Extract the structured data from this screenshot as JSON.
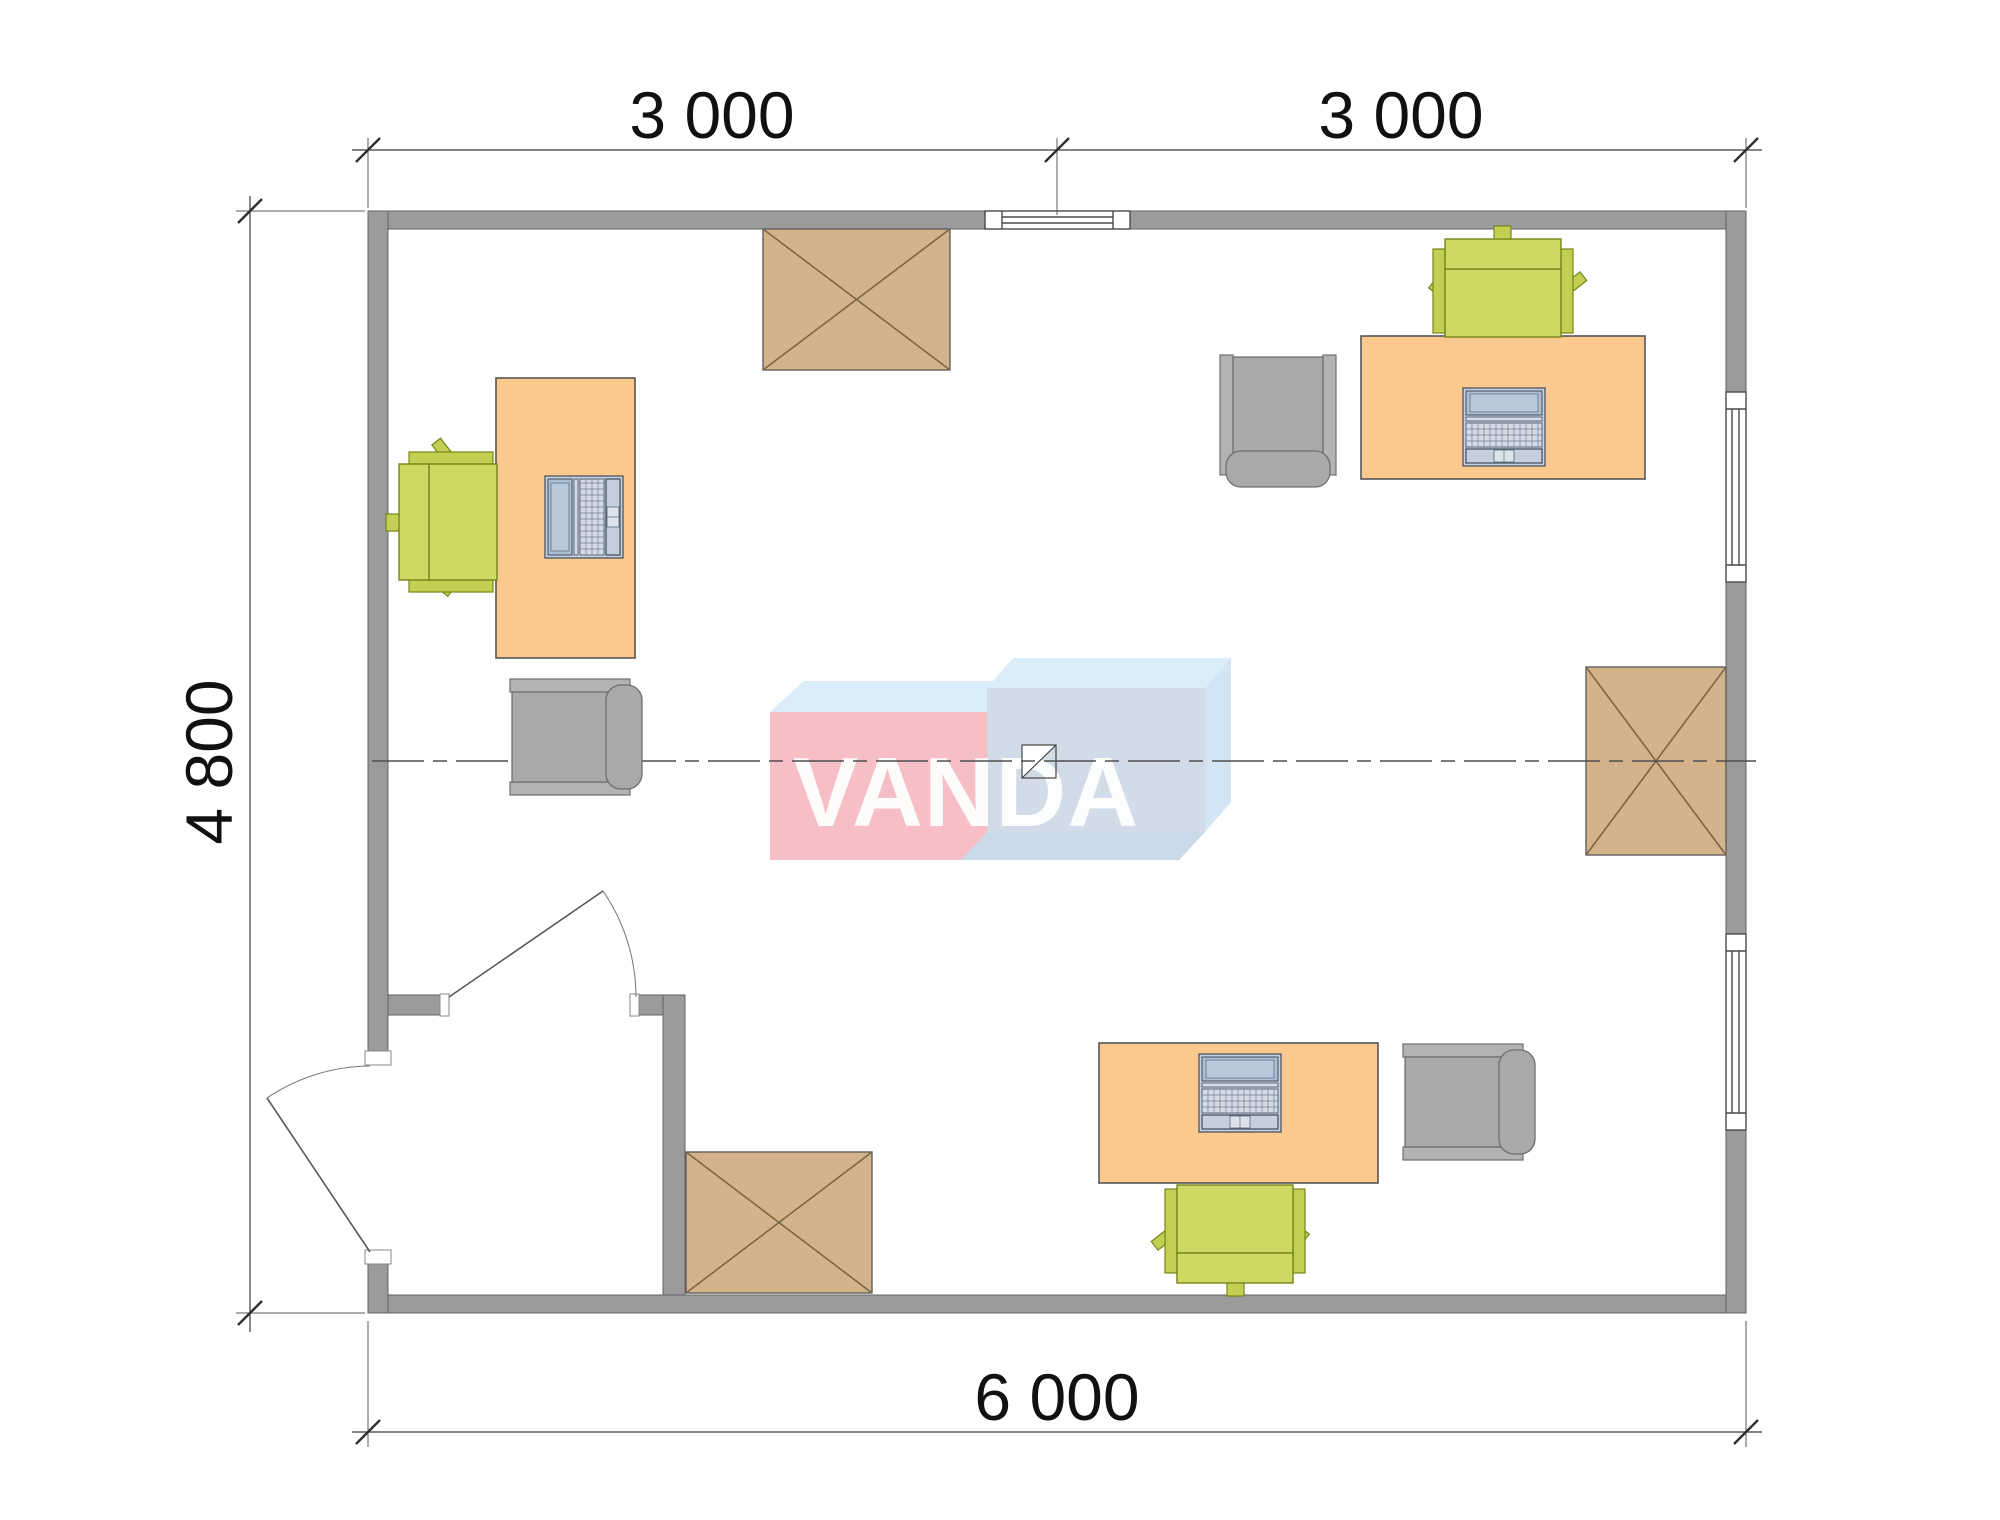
{
  "title": "VANDA office cabin floor plan 6000 x 4800",
  "dimensions": {
    "top_left": "3 000",
    "top_right": "3 000",
    "left": "4 800",
    "bottom": "6 000"
  },
  "watermark": {
    "text": "VANDA"
  },
  "plan": {
    "overall_width_mm": 6000,
    "overall_depth_mm": 4800,
    "rooms": [
      "main office",
      "entry vestibule"
    ],
    "doors": [
      "exterior door in left wall (opens out)",
      "interior vestibule door (opens into office)"
    ],
    "windows": [
      "top wall center window",
      "right wall upper window",
      "right wall lower window"
    ]
  },
  "furniture": {
    "desks": [
      {
        "name": "desk-left",
        "with": "laptop"
      },
      {
        "name": "desk-top-right",
        "with": "laptop"
      },
      {
        "name": "desk-bottom",
        "with": "laptop"
      }
    ],
    "task_chairs_green": 3,
    "visitor_chairs_gray": 3,
    "crossed_cabinets": 3
  },
  "colors": {
    "wall-fill": "#9b9b9b",
    "wall-stroke": "#636363",
    "desk-fill": "#fbc98d",
    "desk-stroke": "#555555",
    "chair-green-fill": "#ced964",
    "chair-green-dark": "#c2cf52",
    "chair-green-stroke": "#76861b",
    "chair-gray-fill": "#a9a9a9",
    "chair-gray-light": "#b3b3b3",
    "chair-gray-stroke": "#6f6f6f",
    "box-fill": "#d4b38a",
    "box-stroke": "#5f5f5f",
    "box-cross": "#7d6645",
    "laptop-body": "#c6d0dd",
    "laptop-screen": "#aebfd3",
    "laptop-stroke": "#3f4c5c",
    "logo-pink": "#f6b9c0",
    "logo-top": "#d8ecf8",
    "logo-blue-front": "#cdd9e6",
    "logo-blue-side": "#cfe3f2",
    "logo-blue-bottom": "#c5d6e6",
    "logo-text": "#ffffff",
    "dim-text": "#111111"
  }
}
